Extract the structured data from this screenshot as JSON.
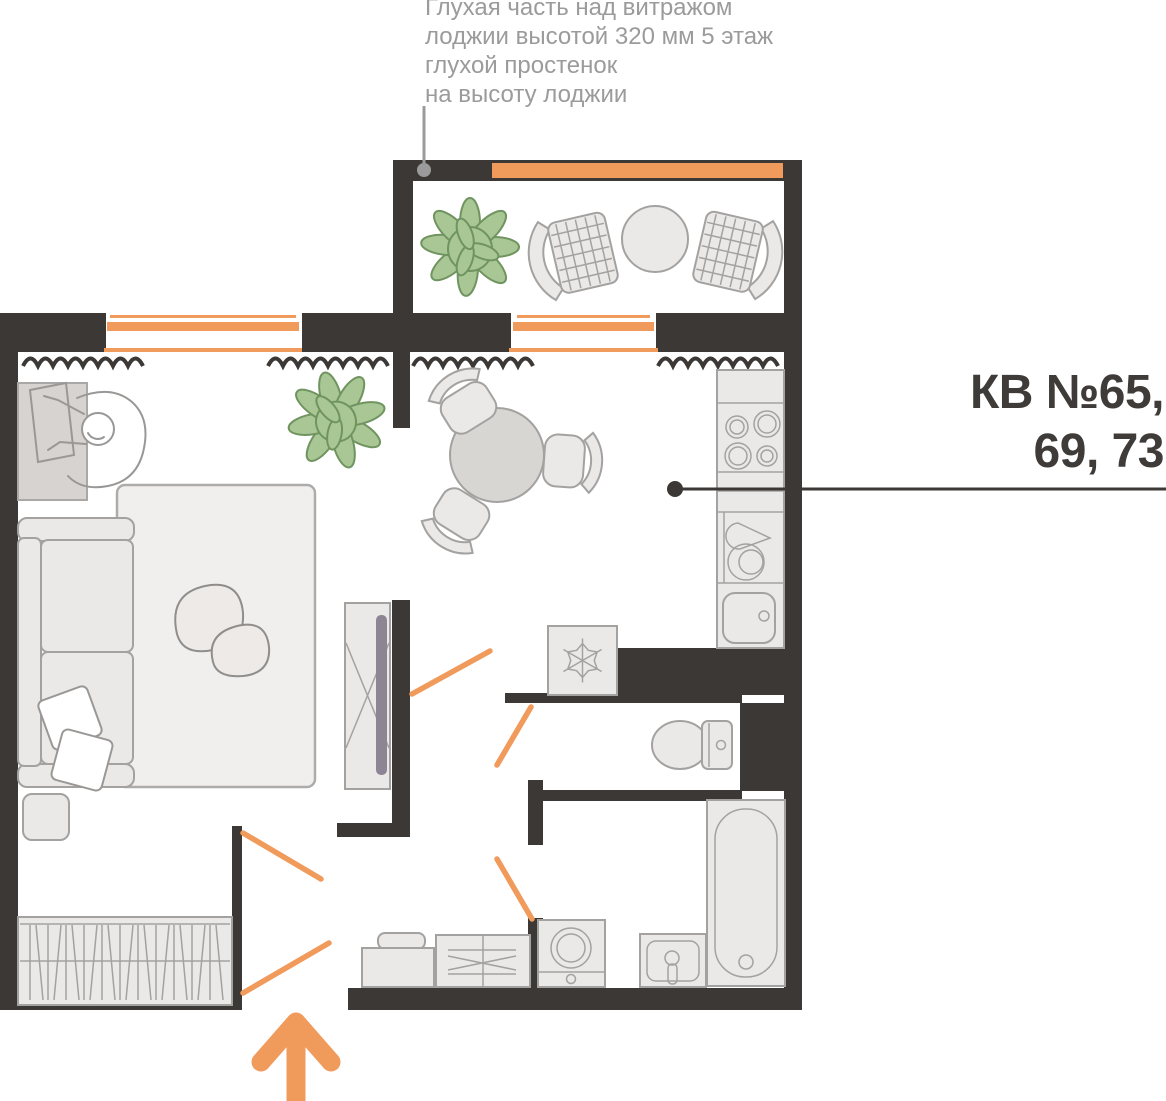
{
  "annotation": {
    "lines": [
      "Глухая часть над витражом",
      "лоджии высотой 320 мм 5 этаж",
      "глухой простенок",
      "на высоту лоджии"
    ]
  },
  "apartment_label": {
    "line1": "КВ №65,",
    "line2": "69, 73"
  },
  "icons": {
    "fridge_icon": "snowflake",
    "entrance_icon": "up-arrow",
    "stove_icon": "four-burners"
  },
  "colors": {
    "wall": "#3B3836",
    "accent": "#F09A5C",
    "furnFill": "#EBE9E7",
    "furnStroke": "#A4A2A0",
    "outline": "#9A9896",
    "plantFill": "#A9C795",
    "plantStroke": "#70945F",
    "annText": "#9B9B9B",
    "labelText": "#3F3B39",
    "rugFill": "#F0EFED",
    "pebbleFill": "#EDEAE7",
    "pebbleStroke": "#908E8C",
    "deskFill": "#D6D3D0",
    "tvScreen": "#8D8494",
    "tableFill": "#D8D6D3"
  }
}
